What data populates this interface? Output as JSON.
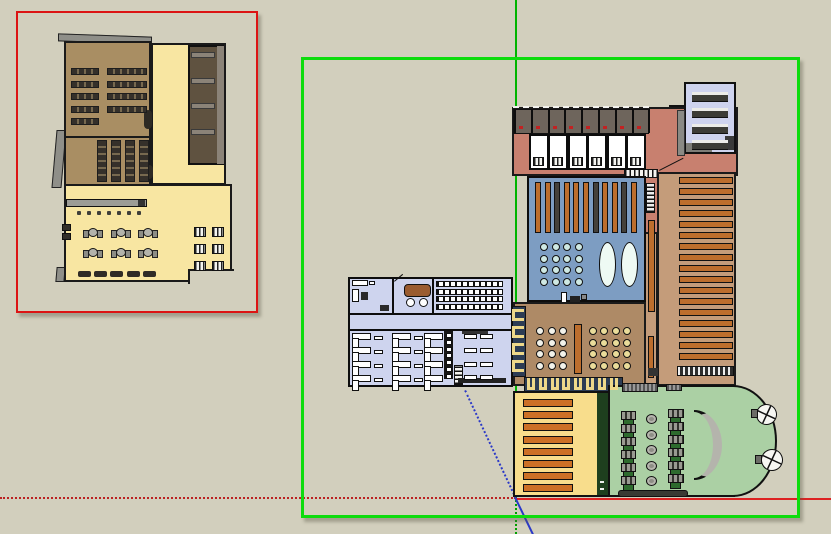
{
  "app": {
    "name": "3d-modeling-viewport",
    "tool_state": "two floor-plan component groups, right group selected"
  },
  "canvas": {
    "width": 831,
    "height": 534,
    "background": "#d2cfbd"
  },
  "palette": {
    "bg": "#d2cfbd",
    "wall": "#111111",
    "brownA": "#a98e63",
    "yellowL": "#f8e6a2",
    "stairs-dark": "#5f5240",
    "gray-bar": "#8b8378",
    "gray-roof": "#8f8f89",
    "salmon": "#c8806f",
    "stall": "#6e655c",
    "lavender": "#ced3ee",
    "blue-room": "#7d9dc2",
    "orange": "#bd6e2d",
    "bar-dark": "#45413a",
    "cyan": "#cfe9e3",
    "oval": "#eefaf4",
    "shelf-bg": "#c49c7a",
    "dining": "#ae8a66",
    "booth-navy": "#2c3c54",
    "booth-yellow": "#edd88a",
    "yellowR": "#f8dd8c",
    "orange2": "#cd7026",
    "green-strip": "#1e3f1e",
    "green-room": "#abd0a4",
    "green-chip": "#2e6b2e",
    "annex": "#ced4ee",
    "sofa": "#9a5c30",
    "selection-red": "#dc1414",
    "selection-green": "#0ddc0d",
    "axis-green": "#00b400",
    "axis-red": "#cc2222",
    "axis-blue": "#2b39c8"
  },
  "selection_boxes": [
    {
      "name": "selection-box-red",
      "x": 16,
      "y": 11,
      "w": 242,
      "h": 302,
      "color": "#dc1414",
      "bw": 2.5
    },
    {
      "name": "selection-box-green",
      "x": 301,
      "y": 57,
      "w": 499,
      "h": 461,
      "color": "#0ddc0d",
      "bw": 3
    }
  ],
  "axis_lines": [
    {
      "name": "axis-green-solid",
      "x": 517,
      "y": 0,
      "len": 497,
      "deg": 90,
      "style": "solid",
      "color": "#00b400",
      "w": 2
    },
    {
      "name": "axis-green-dotted",
      "x": 517,
      "y": 497,
      "len": 37,
      "deg": 90,
      "style": "dotted",
      "color": "#00a000",
      "w": 2
    },
    {
      "name": "axis-red-dotted",
      "x": 0,
      "y": 497,
      "len": 516,
      "deg": 0,
      "style": "dotted",
      "color": "#bb2222",
      "w": 2
    },
    {
      "name": "axis-red-solid",
      "x": 516,
      "y": 498,
      "len": 315,
      "deg": 0,
      "style": "solid",
      "color": "#dd2222",
      "w": 2
    },
    {
      "name": "axis-blue-dotted",
      "x": 466,
      "y": 390,
      "len": 119,
      "deg": 64.8,
      "style": "dotted",
      "color": "#2b39c8",
      "w": 2
    },
    {
      "name": "axis-blue-solid",
      "x": 516,
      "y": 497,
      "len": 42,
      "deg": 64.2,
      "style": "solid",
      "color": "#2b39c8",
      "w": 2
    }
  ],
  "stamps": [
    {
      "name": "desk-row",
      "cls": "bar-desk",
      "x": 71,
      "y": 68,
      "w": 28,
      "h": 7,
      "count": 5,
      "dy": 12.5
    },
    {
      "name": "desk-row",
      "cls": "bar-desk",
      "x": 107,
      "y": 68,
      "w": 40,
      "h": 7,
      "count": 4,
      "dy": 12.5
    },
    {
      "name": "desk-column",
      "cls": "bar-desk-v",
      "x": 97,
      "y": 140,
      "w": 10,
      "h": 42,
      "count": 4,
      "dx": 14
    },
    {
      "name": "stair-tread",
      "cls": "gray-bar",
      "x": 191,
      "y": 52,
      "w": 24,
      "h": 6,
      "count": 4,
      "dy": 25.7
    },
    {
      "name": "small-chair",
      "cls": "dot-dark",
      "x": 77,
      "y": 211,
      "w": 4,
      "h": 4,
      "count": 7,
      "dx": 10
    },
    {
      "name": "cafe-table",
      "cls": "cafe-table",
      "x": 88,
      "y": 228,
      "w": 10,
      "h": 9,
      "count": 3,
      "dx": 27.5
    },
    {
      "name": "cafe-table",
      "cls": "cafe-table",
      "x": 88,
      "y": 248,
      "w": 10,
      "h": 9,
      "count": 3,
      "dx": 27.5
    },
    {
      "name": "bench",
      "cls": "bench",
      "x": 78,
      "y": 271,
      "w": 13,
      "h": 6,
      "count": 5,
      "dx": 16.2
    },
    {
      "name": "booth-unit",
      "cls": "unit-striped",
      "x": 194,
      "y": 227,
      "w": 12,
      "h": 10,
      "count": 6,
      "cols": 2,
      "dx": 18,
      "dy": 17
    },
    {
      "name": "vending-unit",
      "cls": "dark-sq",
      "x": 62,
      "y": 224,
      "w": 9,
      "h": 7,
      "count": 2,
      "dy": 9
    },
    {
      "name": "stall-post",
      "cls": "post",
      "x": 514,
      "y": 109,
      "w": 2,
      "h": 24,
      "count": 9,
      "dx": 16.8
    },
    {
      "name": "stall-red-item",
      "cls": "red-dot",
      "x": 519,
      "y": 126,
      "w": 4,
      "h": 3,
      "count": 8,
      "dx": 16.8
    },
    {
      "name": "dorm-room",
      "cls": "wroom",
      "x": 529,
      "y": 134,
      "w": 20,
      "h": 36,
      "count": 6,
      "dx": 19.4
    },
    {
      "name": "dorm-fixture",
      "cls": "unit-striped",
      "x": 533,
      "y": 157,
      "w": 11,
      "h": 9,
      "count": 6,
      "dx": 19.4
    },
    {
      "name": "stack-shelf",
      "cls": "vbar",
      "x": 535,
      "y": 182,
      "w": 6,
      "h": 51,
      "count": 11,
      "dx": 9.6,
      "colors": [
        "#bd6e2d",
        "#bd6e2d",
        "#45413a",
        "#bd6e2d",
        "#bd6e2d",
        "#bd6e2d",
        "#45413a",
        "#bd6e2d",
        "#bd6e2d",
        "#45413a",
        "#bd6e2d"
      ]
    },
    {
      "name": "reading-seat",
      "cls": "circ-cyan",
      "x": 540,
      "y": 243,
      "w": 8,
      "h": 8,
      "count": 16,
      "cols": 4,
      "dx": 11.5,
      "dy": 11.7
    },
    {
      "name": "library-shelf",
      "cls": "shelf-bar",
      "x": 679,
      "y": 177,
      "w": 54,
      "h": 7,
      "count": 17,
      "dy": 11
    },
    {
      "name": "library-shelf",
      "cls": "shelf-bar2",
      "x": 523,
      "y": 399,
      "w": 50,
      "h": 8,
      "count": 8,
      "dy": 12.2
    },
    {
      "name": "dining-table",
      "cls": "circ-white",
      "x": 536,
      "y": 327,
      "w": 8,
      "h": 8,
      "count": 12,
      "cols": 3,
      "dx": 11.5,
      "dy": 11.6
    },
    {
      "name": "dining-table",
      "cls": "circ-cream",
      "x": 589,
      "y": 327,
      "w": 8,
      "h": 8,
      "count": 16,
      "cols": 4,
      "dx": 11.4,
      "dy": 11.6
    },
    {
      "name": "booth-seat",
      "cls": "booth-left",
      "x": 512,
      "y": 309,
      "w": 12,
      "h": 12,
      "count": 4,
      "dy": 17
    },
    {
      "name": "booth-seat",
      "cls": "booth-bottom",
      "x": 527,
      "y": 378,
      "w": 8,
      "h": 12,
      "count": 8,
      "dx": 11.8
    },
    {
      "name": "computer-desk",
      "cls": "gdesk",
      "x": 621,
      "y": 411,
      "w": 15,
      "h": 14,
      "count": 6,
      "dy": 13
    },
    {
      "name": "computer-desk",
      "cls": "gdesk",
      "x": 668,
      "y": 409,
      "w": 16,
      "h": 14,
      "count": 6,
      "dy": 13
    },
    {
      "name": "round-table",
      "cls": "circ-gray",
      "x": 646,
      "y": 414,
      "w": 11,
      "h": 10,
      "count": 5,
      "dy": 15.6
    },
    {
      "name": "stair-tread",
      "cls": "lav-bar",
      "x": 692,
      "y": 92,
      "w": 36,
      "h": 10,
      "count": 4,
      "dy": 16
    },
    {
      "name": "seminar-row",
      "cls": "bar-striped",
      "x": 436,
      "y": 281,
      "w": 67,
      "h": 6,
      "count": 4,
      "dy": 7.5
    },
    {
      "name": "office-desk",
      "cls": "adesk",
      "x": 352,
      "y": 333,
      "w": 22,
      "h": 14,
      "count": 4,
      "dy": 14
    },
    {
      "name": "office-desk",
      "cls": "adesk",
      "x": 392,
      "y": 333,
      "w": 22,
      "h": 14,
      "count": 4,
      "dy": 14
    },
    {
      "name": "office-desk",
      "cls": "adesk",
      "x": 424,
      "y": 333,
      "w": 22,
      "h": 14,
      "count": 4,
      "dy": 14
    },
    {
      "name": "side-table",
      "cls": "sbar",
      "x": 374,
      "y": 336,
      "w": 9,
      "h": 4,
      "count": 4,
      "dy": 14
    },
    {
      "name": "side-table",
      "cls": "sbar",
      "x": 414,
      "y": 336,
      "w": 9,
      "h": 4,
      "count": 4,
      "dy": 14
    },
    {
      "name": "locker-cell",
      "cls": "comb-cell",
      "x": 446,
      "y": 333,
      "w": 6,
      "h": 5,
      "count": 7,
      "dy": 6.8
    },
    {
      "name": "work-table",
      "cls": "sbar2",
      "x": 464,
      "y": 334,
      "w": 13,
      "h": 5,
      "count": 8,
      "cols": 2,
      "dx": 16,
      "dy": 13.8
    }
  ]
}
